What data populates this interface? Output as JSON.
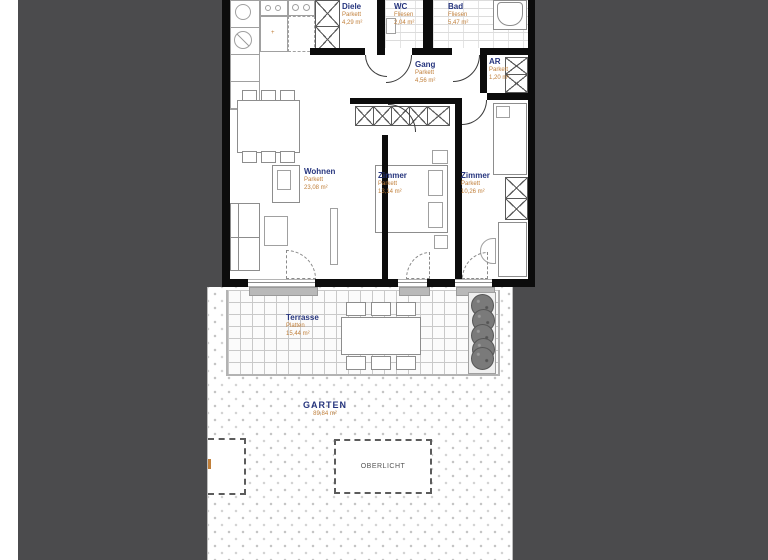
{
  "viewer": {
    "canvas_color": "#4b4b4d",
    "page_color": "#ffffff",
    "wall_color": "#0c0c0c",
    "room_name_color": "#26357e",
    "room_info_color": "#c07f3a"
  },
  "plan": {
    "type": "apartment-floor-plan",
    "rooms": [
      {
        "name": "Diele",
        "floor": "Parkett",
        "area": "4,29 m²"
      },
      {
        "name": "WC",
        "floor": "Fliesen",
        "area": "2,04 m²"
      },
      {
        "name": "Bad",
        "floor": "Fliesen",
        "area": "5,47 m²"
      },
      {
        "name": "Gang",
        "floor": "Parkett",
        "area": "4,56 m²"
      },
      {
        "name": "AR",
        "floor": "Parkett",
        "area": "1,20 m²"
      },
      {
        "name": "Wohnen",
        "floor": "Parkett",
        "area": "23,08 m²"
      },
      {
        "name": "Zimmer",
        "floor": "Parkett",
        "area": "13,14 m²"
      },
      {
        "name": "Zimmer",
        "floor": "Parkett",
        "area": "10,26 m²"
      },
      {
        "name": "Terrasse",
        "floor": "Platten",
        "area": "15,44 m²"
      },
      {
        "name": "GARTEN",
        "area": "89,84 m²"
      },
      {
        "name": "OBERLICHT"
      }
    ],
    "furniture": [
      "stove",
      "sink",
      "oven",
      "kitchen-cabinet",
      "toilet",
      "bathtub",
      "storage-cabinet",
      "dining-table",
      "chairs",
      "tv-board",
      "sofa",
      "coffee-table",
      "sideboard",
      "wardrobe",
      "bed",
      "nightstand",
      "desk",
      "desk-chair",
      "terrace-table",
      "terrace-chairs",
      "planter"
    ],
    "marks": {
      "counter_plus": "+"
    }
  }
}
